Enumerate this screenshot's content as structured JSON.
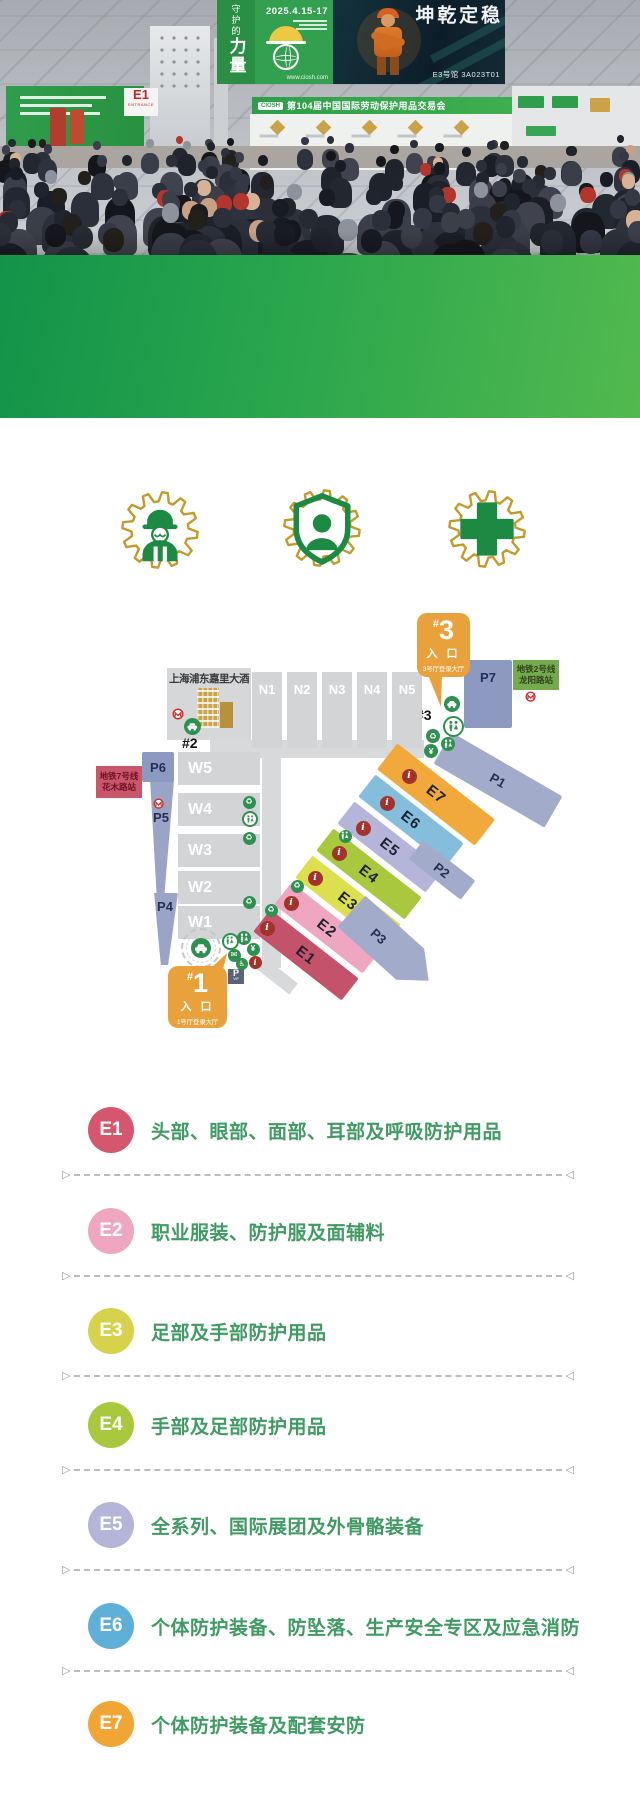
{
  "hero": {
    "hanging_banner": {
      "title_small": "守护的",
      "title_large": "力量",
      "date": "2025.4.15-17",
      "website": "www.ciosh.com"
    },
    "dark_banner": {
      "calligraphy": "稳定乾坤",
      "booth_no": "E3号馆 3A023T01"
    },
    "strip_banner": {
      "logo": "CIOSH",
      "title": "第104届中国国际劳动保护用品交易会"
    },
    "entrance_sign": {
      "code": "E1",
      "word": "ENTRANCE"
    }
  },
  "stats": {
    "items": [
      {
        "icon": "floor-area-icon",
        "value": "80,000",
        "plus": "+",
        "unit": "m²",
        "label": "展会总面积"
      },
      {
        "icon": "exhibitors-icon",
        "value": "1,500",
        "plus": "+",
        "unit": "",
        "label": "参展商"
      },
      {
        "icon": "visitors-icon",
        "value": "40,000",
        "plus": "+",
        "unit": "",
        "label": "专业观众"
      }
    ]
  },
  "features": {
    "icons": [
      "worker-gear-icon",
      "shield-person-gear-icon",
      "medical-cross-gear-icon"
    ]
  },
  "map": {
    "hotel": {
      "label": "上海浦东嘉里大酒店"
    },
    "entrance1": {
      "prefix": "#",
      "num": "1",
      "title": "入 口",
      "subtitle": "1号厅登录大厅"
    },
    "entrance3": {
      "prefix": "#",
      "num": "3",
      "title": "入 口",
      "subtitle": "3号厅登录大厅"
    },
    "marker2": "#2",
    "marker3": "#3",
    "metro_line7": {
      "line": "地铁7号线",
      "station": "花木路站"
    },
    "metro_line2": {
      "line": "地铁2号线",
      "station": "龙阳路站"
    },
    "vip_parking": {
      "p": "P",
      "vip": "VIP"
    },
    "north_halls": [
      {
        "label": "N1",
        "x": 252,
        "y": 672,
        "w": 30,
        "h": 76
      },
      {
        "label": "N2",
        "x": 287,
        "y": 672,
        "w": 30,
        "h": 76
      },
      {
        "label": "N3",
        "x": 322,
        "y": 672,
        "w": 30,
        "h": 76
      },
      {
        "label": "N4",
        "x": 357,
        "y": 672,
        "w": 30,
        "h": 76
      },
      {
        "label": "N5",
        "x": 392,
        "y": 672,
        "w": 30,
        "h": 76
      }
    ],
    "west_halls": [
      {
        "label": "W5",
        "x": 178,
        "y": 752,
        "w": 82,
        "h": 33
      },
      {
        "label": "W4",
        "x": 178,
        "y": 793,
        "w": 82,
        "h": 33
      },
      {
        "label": "W3",
        "x": 178,
        "y": 834,
        "w": 82,
        "h": 33
      },
      {
        "label": "W2",
        "x": 178,
        "y": 871,
        "w": 82,
        "h": 33
      },
      {
        "label": "W1",
        "x": 178,
        "y": 906,
        "w": 82,
        "h": 33
      }
    ],
    "east_halls": [
      {
        "label": "E1",
        "color": "#c4526a",
        "cx": 306,
        "cy": 955,
        "len": 112,
        "wid": 28
      },
      {
        "label": "E2",
        "color": "#efa6c0",
        "cx": 327,
        "cy": 928,
        "len": 112,
        "wid": 28
      },
      {
        "label": "E3",
        "color": "#dce04e",
        "cx": 348,
        "cy": 901,
        "len": 112,
        "wid": 28
      },
      {
        "label": "E4",
        "color": "#a8c83e",
        "cx": 369,
        "cy": 874,
        "len": 112,
        "wid": 28
      },
      {
        "label": "E5",
        "color": "#b5b5da",
        "cx": 390,
        "cy": 847,
        "len": 112,
        "wid": 28
      },
      {
        "label": "E6",
        "color": "#85bddd",
        "cx": 411,
        "cy": 820,
        "len": 112,
        "wid": 28
      },
      {
        "label": "E7",
        "color": "#f2a93c",
        "cx": 436,
        "cy": 794,
        "len": 124,
        "wid": 33
      }
    ],
    "parking": [
      {
        "label": "P1",
        "cx": 498,
        "cy": 780,
        "w": 128,
        "h": 36,
        "rot": 30,
        "color": "#a2abc9"
      },
      {
        "label": "P2",
        "cx": 442,
        "cy": 870,
        "w": 66,
        "h": 24,
        "rot": 38,
        "color": "#a2abc9"
      },
      {
        "label": "P3",
        "cx": 390,
        "cy": 946,
        "w": 104,
        "h": 42,
        "rot": 42,
        "shape": "arrow",
        "color": "#a2abc9"
      },
      {
        "label": "P4",
        "cx": 165,
        "cy": 929,
        "w": 26,
        "h": 72,
        "shape": "wedge",
        "ltop": 6,
        "color": "#9aa4c6"
      },
      {
        "label": "P5",
        "cx": 161,
        "cy": 839,
        "w": 26,
        "h": 118,
        "shape": "wedge",
        "ltop": 30,
        "color": "#9aa4c6"
      },
      {
        "label": "P6",
        "cx": 158,
        "cy": 767,
        "w": 32,
        "h": 30,
        "color": "#8d99c1"
      },
      {
        "label": "P7",
        "cx": 488,
        "cy": 694,
        "w": 48,
        "h": 68,
        "ltop": 10,
        "color": "#8d99c1"
      }
    ],
    "corridors": [
      {
        "x": 210,
        "y": 740,
        "w": 214,
        "h": 18
      },
      {
        "x": 262,
        "y": 740,
        "w": 19,
        "h": 228
      },
      {
        "cx": 277,
        "cy": 976,
        "w": 42,
        "h": 14,
        "rot": 38
      }
    ],
    "icons": [
      {
        "t": "metro",
        "x": 178,
        "y": 714,
        "d": 14
      },
      {
        "t": "car",
        "x": 192,
        "y": 726,
        "d": 17
      },
      {
        "t": "metro",
        "x": 159,
        "y": 804,
        "d": 13
      },
      {
        "t": "metro",
        "x": 531,
        "y": 697,
        "d": 13
      },
      {
        "t": "car",
        "x": 452,
        "y": 704,
        "d": 16
      },
      {
        "t": "ringwc",
        "x": 453,
        "y": 726,
        "d": 21
      },
      {
        "t": "recycle",
        "x": 433,
        "y": 736,
        "d": 14
      },
      {
        "t": "wc",
        "x": 448,
        "y": 744,
        "d": 14
      },
      {
        "t": "yen",
        "x": 431,
        "y": 751,
        "d": 14
      },
      {
        "t": "recycle",
        "x": 249,
        "y": 802,
        "d": 13
      },
      {
        "t": "ringwc",
        "x": 250,
        "y": 819,
        "d": 16
      },
      {
        "t": "recycle",
        "x": 249,
        "y": 838,
        "d": 13
      },
      {
        "t": "recycle",
        "x": 249,
        "y": 902,
        "d": 13
      },
      {
        "t": "recycle",
        "x": 271,
        "y": 910,
        "d": 13
      },
      {
        "t": "recycle",
        "x": 297,
        "y": 886,
        "d": 13
      },
      {
        "t": "wc",
        "x": 345,
        "y": 836,
        "d": 13
      },
      {
        "t": "cardash",
        "x": 201,
        "y": 948,
        "d": 40
      },
      {
        "t": "ringwc",
        "x": 230,
        "y": 941,
        "d": 17
      },
      {
        "t": "wc",
        "x": 244,
        "y": 938,
        "d": 14
      },
      {
        "t": "yen",
        "x": 253,
        "y": 949,
        "d": 13
      },
      {
        "t": "mail",
        "x": 234,
        "y": 955,
        "d": 13
      },
      {
        "t": "wheel",
        "x": 242,
        "y": 964,
        "d": 12
      },
      {
        "t": "info",
        "x": 255,
        "y": 962,
        "d": 13
      },
      {
        "t": "info",
        "x": 267,
        "y": 928,
        "d": 15
      },
      {
        "t": "info",
        "x": 291,
        "y": 903,
        "d": 15
      },
      {
        "t": "info",
        "x": 315,
        "y": 878,
        "d": 15
      },
      {
        "t": "info",
        "x": 339,
        "y": 853,
        "d": 15
      },
      {
        "t": "info",
        "x": 363,
        "y": 828,
        "d": 15
      },
      {
        "t": "info",
        "x": 387,
        "y": 803,
        "d": 15
      },
      {
        "t": "info",
        "x": 409,
        "y": 776,
        "d": 15
      }
    ]
  },
  "legend": {
    "rows": [
      {
        "code": "E1",
        "color": "#d5576d",
        "text": "头部、眼部、面部、耳部及呼吸防护用品"
      },
      {
        "code": "E2",
        "color": "#efa6c0",
        "text": "职业服装、防护服及面辅料"
      },
      {
        "code": "E3",
        "color": "#d6d24b",
        "text": "足部及手部防护用品"
      },
      {
        "code": "E4",
        "color": "#a8c83e",
        "text": "手部及足部防护用品"
      },
      {
        "code": "E5",
        "color": "#b5b5da",
        "text": "全系列、国际展团及外骨骼装备"
      },
      {
        "code": "E6",
        "color": "#5fb0d8",
        "text": "个体防护装备、防坠落、生产安全专区及应急消防"
      },
      {
        "code": "E7",
        "color": "#f0a534",
        "text": "个体防护装备及配套安防"
      }
    ]
  },
  "colors": {
    "band_green_dark": "#13934a",
    "band_green_light": "#52b94e",
    "gold": "#c49a2a",
    "icon_green": "#1d8a44",
    "legend_text_green": "#3f9b62",
    "callout_orange": "#e9a23b",
    "hall_gray": "#d3d4d6",
    "parking_blue": "#8d99c1",
    "info_red": "#a3332a",
    "service_green": "#2e9150",
    "metro_red": "#cf2e2e"
  }
}
